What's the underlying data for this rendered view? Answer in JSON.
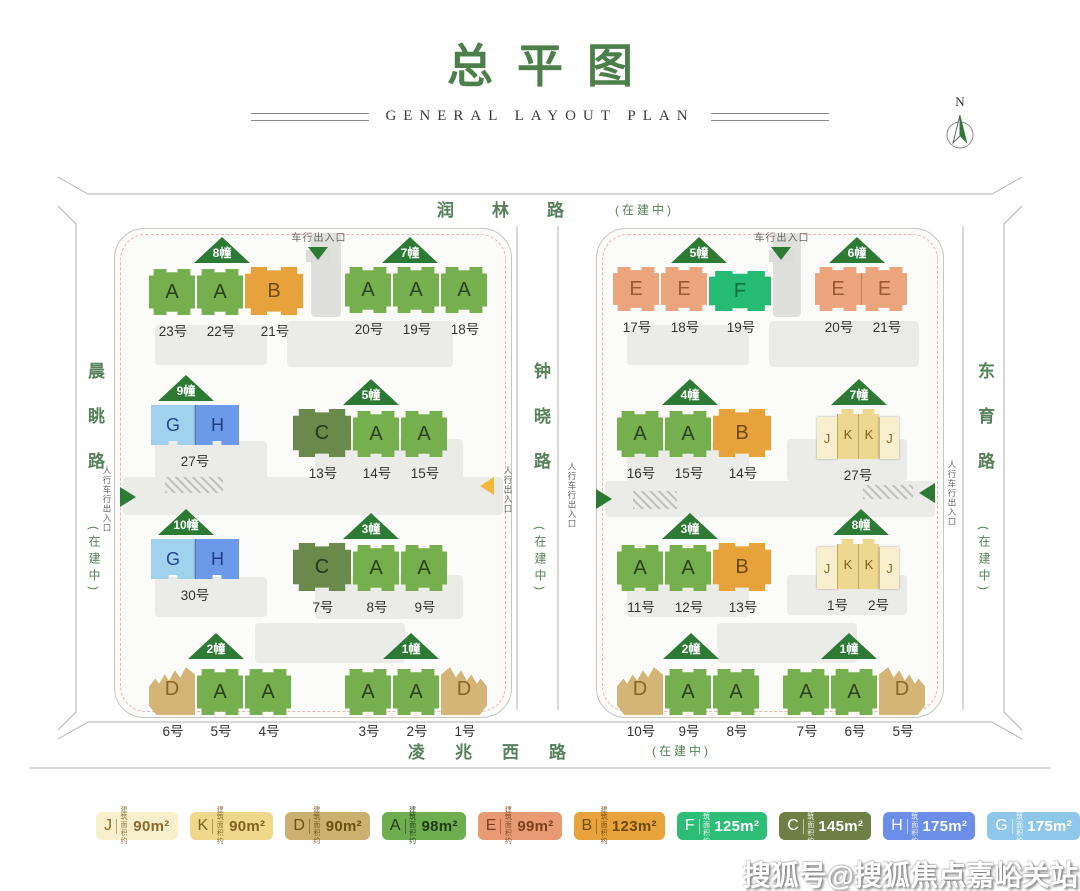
{
  "header": {
    "title": "总平图",
    "subtitle": "GENERAL LAYOUT PLAN",
    "north_label": "N"
  },
  "roads": {
    "top": {
      "name": "润林路",
      "status": "(在建中)"
    },
    "left": {
      "name": "晨眺路",
      "status": "(在建中)"
    },
    "middle": {
      "name": "钟晓路",
      "status": "(在建中)"
    },
    "right": {
      "name": "东育路",
      "status": "(在建中)"
    },
    "bottom": {
      "name": "凌兆西路",
      "status": "(在建中)"
    }
  },
  "entrances": {
    "vehicle": "车行出入口",
    "ped_vehicle": "人行车行出入口",
    "ped": "人行出入口"
  },
  "compounds": {
    "left": {
      "groups": [
        {
          "marker": "8幢",
          "joined": false,
          "units": [
            "A",
            "A",
            "B"
          ],
          "numbers": [
            "23号",
            "22号",
            "21号"
          ]
        },
        {
          "marker": "7幢",
          "joined": false,
          "units": [
            "A",
            "A",
            "A"
          ],
          "numbers": [
            "20号",
            "19号",
            "18号"
          ]
        },
        {
          "marker": "9幢",
          "joined": true,
          "units": [
            "G",
            "H"
          ],
          "numbers": [
            "27号"
          ]
        },
        {
          "marker": "5幢",
          "joined": false,
          "units": [
            "C",
            "A",
            "A"
          ],
          "numbers": [
            "13号",
            "14号",
            "15号"
          ]
        },
        {
          "marker": "10幢",
          "joined": true,
          "units": [
            "G",
            "H"
          ],
          "numbers": [
            "30号"
          ]
        },
        {
          "marker": "3幢",
          "joined": false,
          "units": [
            "C",
            "A",
            "A"
          ],
          "numbers": [
            "7号",
            "8号",
            "9号"
          ]
        },
        {
          "marker": "2幢",
          "joined": false,
          "units": [
            "D",
            "A",
            "A"
          ],
          "numbers": [
            "6号",
            "5号",
            "4号"
          ]
        },
        {
          "marker": "1幢",
          "joined": false,
          "units": [
            "A",
            "A",
            "D"
          ],
          "numbers": [
            "3号",
            "2号",
            "1号"
          ]
        }
      ]
    },
    "right": {
      "groups": [
        {
          "marker": "5幢",
          "joined": false,
          "units": [
            "E",
            "E",
            "F"
          ],
          "numbers": [
            "17号",
            "18号",
            "19号"
          ]
        },
        {
          "marker": "6幢",
          "joined": true,
          "units": [
            "E",
            "E"
          ],
          "numbers": [
            "20号",
            "21号"
          ]
        },
        {
          "marker": "4幢",
          "joined": false,
          "units": [
            "A",
            "A",
            "B"
          ],
          "numbers": [
            "16号",
            "15号",
            "14号"
          ]
        },
        {
          "marker": "7幢",
          "joined": true,
          "units": [
            "J",
            "K",
            "K",
            "J"
          ],
          "numbers": [
            "27号"
          ]
        },
        {
          "marker": "3幢",
          "joined": false,
          "units": [
            "A",
            "A",
            "B"
          ],
          "numbers": [
            "11号",
            "12号",
            "13号"
          ]
        },
        {
          "marker": "8幢",
          "joined": true,
          "units": [
            "J",
            "K",
            "K",
            "J"
          ],
          "numbers": [
            "1号",
            "2号"
          ]
        },
        {
          "marker": "2幢",
          "joined": false,
          "units": [
            "D",
            "A",
            "A"
          ],
          "numbers": [
            "10号",
            "9号",
            "8号"
          ]
        },
        {
          "marker": "1幢",
          "joined": false,
          "units": [
            "A",
            "A",
            "D"
          ],
          "numbers": [
            "7号",
            "6号",
            "5号"
          ]
        }
      ]
    }
  },
  "legend": {
    "area_label_top": "建 筑",
    "area_label_bottom": "面积约",
    "items": [
      {
        "letter": "J",
        "area": "90m²",
        "bg": "#f8efcd",
        "fg": "#8a6a2e"
      },
      {
        "letter": "K",
        "area": "90m²",
        "bg": "#efd88c",
        "fg": "#80611f"
      },
      {
        "letter": "D",
        "area": "90m²",
        "bg": "#cbb071",
        "fg": "#6b5115"
      },
      {
        "letter": "A",
        "area": "98m²",
        "bg": "#6fae50",
        "fg": "#1d3a10"
      },
      {
        "letter": "E",
        "area": "99m²",
        "bg": "#e89b72",
        "fg": "#7c3f1d"
      },
      {
        "letter": "B",
        "area": "123m²",
        "bg": "#e8a33c",
        "fg": "#6e4a08"
      },
      {
        "letter": "F",
        "area": "125m²",
        "bg": "#2ebd76",
        "fg": "#ffffff"
      },
      {
        "letter": "C",
        "area": "145m²",
        "bg": "#6e7f46",
        "fg": "#ffffff"
      },
      {
        "letter": "H",
        "area": "175m²",
        "bg": "#6b8ee9",
        "fg": "#ffffff"
      },
      {
        "letter": "G",
        "area": "175m²",
        "bg": "#8fc7eb",
        "fg": "#ffffff"
      }
    ]
  },
  "watermark": {
    "text": "搜狐号@搜狐焦点嘉峪关站"
  },
  "colors": {
    "accent": "#4d7f4b",
    "marker": "#2d7a35",
    "road_text": "#56815a",
    "arrow_yellow": "#f3b73c",
    "units": {
      "A": "#76af4e",
      "B": "#e8a23c",
      "C": "#6b894a",
      "D": "#d4b577",
      "E": "#eba47c",
      "F": "#25bb72",
      "G": "#a0d2ee",
      "H": "#6d99e9",
      "J": "#f8efcf",
      "K": "#eed88f"
    },
    "unit_text": {
      "A": "#29421b",
      "B": "#6e4a0e",
      "C": "#24391a",
      "D": "#8a6527",
      "E": "#9c5a30",
      "F": "#0b6e40",
      "G": "#2a4590",
      "H": "#223c85",
      "J": "#8a6a2a",
      "K": "#7c5e1d"
    }
  }
}
